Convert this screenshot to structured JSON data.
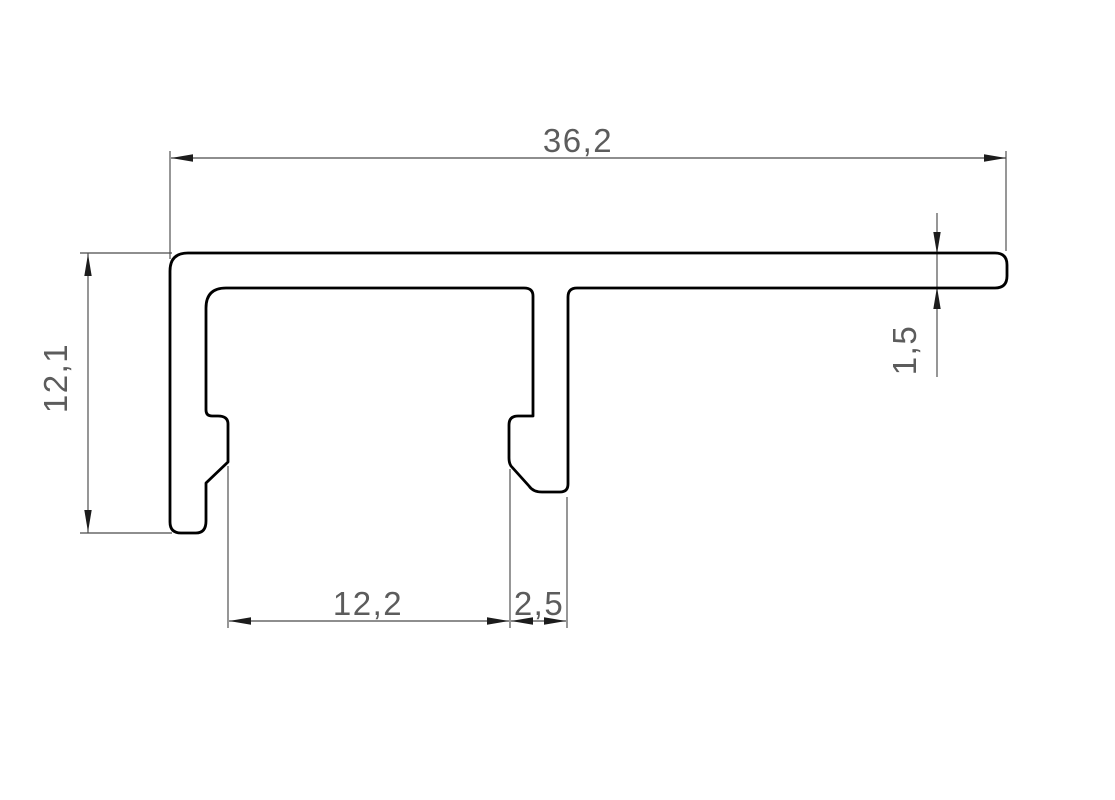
{
  "drawing": {
    "kind": "technical-cross-section-drawing",
    "labels": {
      "total_width": "36,2",
      "total_height": "12,1",
      "opening_width": "12,2",
      "foot_width": "2,5",
      "wall_thickness": "1,5"
    },
    "colors": {
      "background": "#ffffff",
      "profile_outline": "#000000",
      "dimension_lines": "#4a4a4a",
      "arrowheads": "#1c1c1c",
      "dimension_text": "#5c5c5c"
    }
  }
}
